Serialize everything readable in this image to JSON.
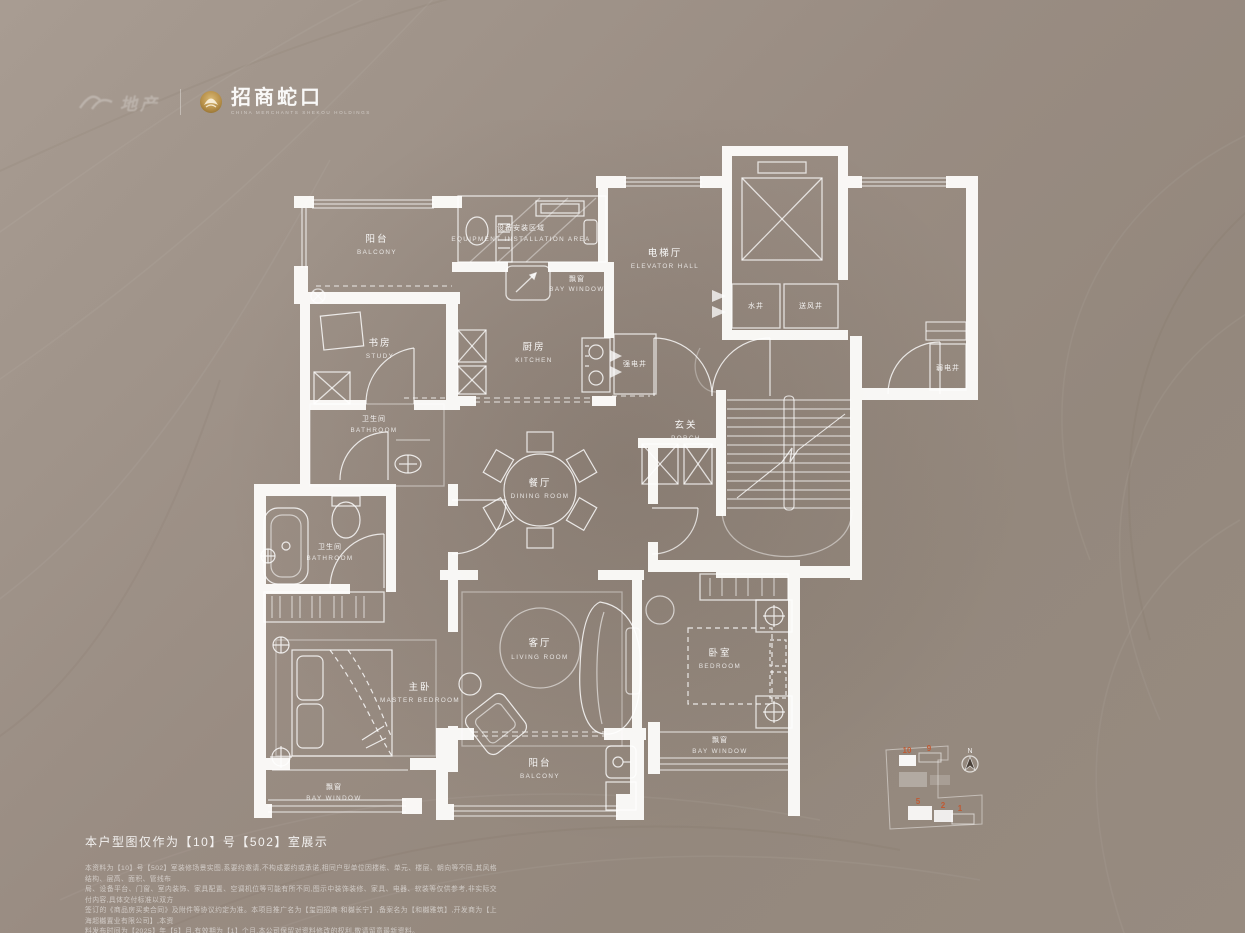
{
  "header": {
    "partner_logo_text": "地产",
    "brand_logo_text": "招商蛇口",
    "brand_logo_subtext": "CHINA MERCHANTS SHEKOU HOLDINGS",
    "brand_gold": "#bb954a"
  },
  "plan": {
    "rooms": [
      {
        "id": "balcony-top",
        "zh": "阳台",
        "en": "BALCONY"
      },
      {
        "id": "equipment-area",
        "zh": "设备安装区域",
        "en": "EQUIPMENT INSTALLATION AREA"
      },
      {
        "id": "bay-window-top",
        "zh": "飘窗",
        "en": "BAY WINDOW"
      },
      {
        "id": "elevator-hall",
        "zh": "电梯厅",
        "en": "ELEVATOR HALL"
      },
      {
        "id": "water-shaft",
        "zh": "水井",
        "en": ""
      },
      {
        "id": "air-supply-shaft",
        "zh": "送风井",
        "en": ""
      },
      {
        "id": "study",
        "zh": "书房",
        "en": "STUDY"
      },
      {
        "id": "kitchen",
        "zh": "厨房",
        "en": "KITCHEN"
      },
      {
        "id": "strong-electric-shaft",
        "zh": "强电井",
        "en": ""
      },
      {
        "id": "weak-electric-shaft",
        "zh": "弱电井",
        "en": ""
      },
      {
        "id": "bathroom-upper",
        "zh": "卫生间",
        "en": "BATHROOM"
      },
      {
        "id": "porch",
        "zh": "玄关",
        "en": "PORCH"
      },
      {
        "id": "dining-room",
        "zh": "餐厅",
        "en": "DINING ROOM"
      },
      {
        "id": "bathroom-lower",
        "zh": "卫生间",
        "en": "BATHROOM"
      },
      {
        "id": "living-room",
        "zh": "客厅",
        "en": "LIVING ROOM"
      },
      {
        "id": "master-bedroom",
        "zh": "主卧",
        "en": "MASTER BEDROOM"
      },
      {
        "id": "bedroom",
        "zh": "卧室",
        "en": "BEDROOM"
      },
      {
        "id": "bay-window-left",
        "zh": "飘窗",
        "en": "BAY WINDOW"
      },
      {
        "id": "bay-window-right",
        "zh": "飘窗",
        "en": "BAY WINDOW"
      },
      {
        "id": "balcony-bottom",
        "zh": "阳台",
        "en": "BALCONY"
      }
    ]
  },
  "keyplan": {
    "compass_label": "N",
    "number_color": "#c05a33",
    "buildings": [
      "10",
      "9",
      "5",
      "2",
      "1"
    ]
  },
  "footer": {
    "caption": "本户型图仅作为【10】号【502】室展示",
    "disclaimer_lines": [
      "本资料为【10】号【502】室装修场景实图,系要约邀请,不构成要约或承诺,相同户型单位因楼栋、单元、楼层、朝向等不同,其风格结构、层高、面积、管线布",
      "局、设备平台、门窗、室内装饰、家具配置、空调机位等可能有所不同,图示中装饰装修、家具、电器、软装等仅供参考,非实际交付内容,具体交付标准以双方",
      "签订的《商品房买卖合同》及附件等协议约定为准。本项目推广名为【玺园招商·和樾长宁】,备案名为【和樾雅筑】,开发商为【上海超樾置业有限公司】,本资",
      "料发布时间为【2025】年【5】月,有效期为【1】个月,本公司保留对资料修改的权利,敬请留意最新资料。"
    ]
  }
}
